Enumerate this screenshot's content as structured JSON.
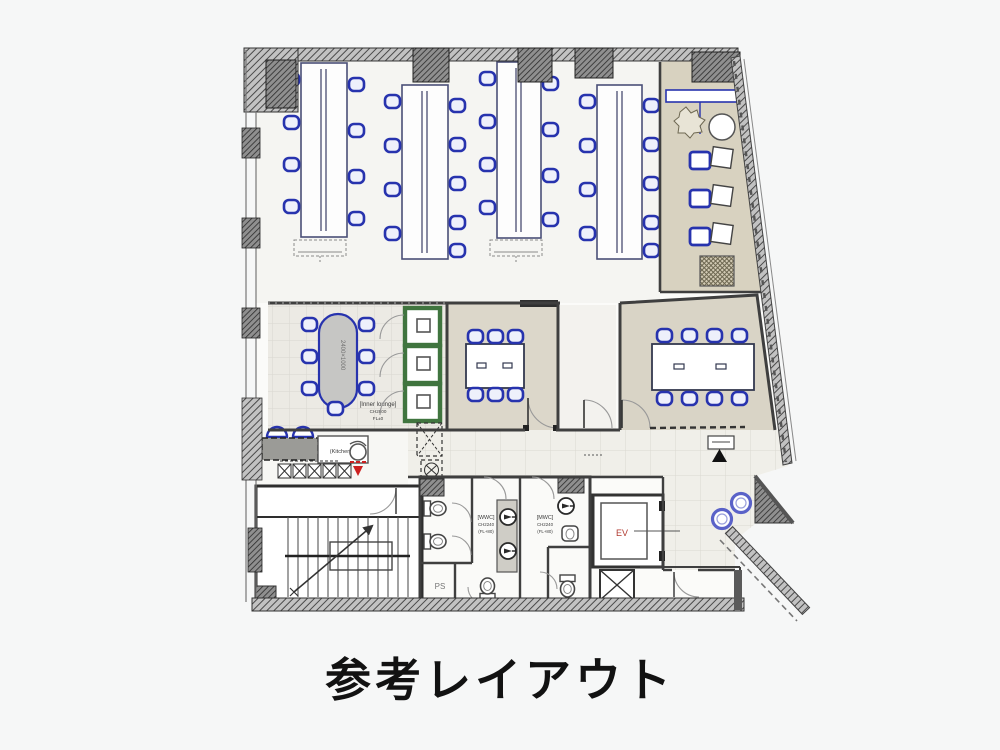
{
  "title": "参考レイアウト",
  "rooms": {
    "inner_lounge": {
      "label": "[Inner lounge]",
      "ceiling_height": "CH2800",
      "floor_level": "FL±0",
      "table_dimension": "2400×1000"
    },
    "kitchen": {
      "label": "(Kitchen)"
    },
    "womens_toilet": {
      "label": "[WWC]",
      "ceiling_height": "CH2240",
      "floor_level": "(FL+80)"
    },
    "mens_toilet": {
      "label": "[MWC]",
      "ceiling_height": "CH2240",
      "floor_level": "(FL+80)"
    },
    "pipe_shaft": {
      "label": "PS"
    },
    "elevator": {
      "label": "EV"
    }
  },
  "colors": {
    "chair_blue": "#2733ae",
    "booth_green": "#40753f",
    "lounge_floor_beige": "#d8d2c0",
    "meeting_floor_beige": "#dcd7ca",
    "wall_dark": "#3f3f3f",
    "ev_label_red": "#b03a30",
    "accent_red": "#cc2020",
    "title_color": "#121212"
  }
}
